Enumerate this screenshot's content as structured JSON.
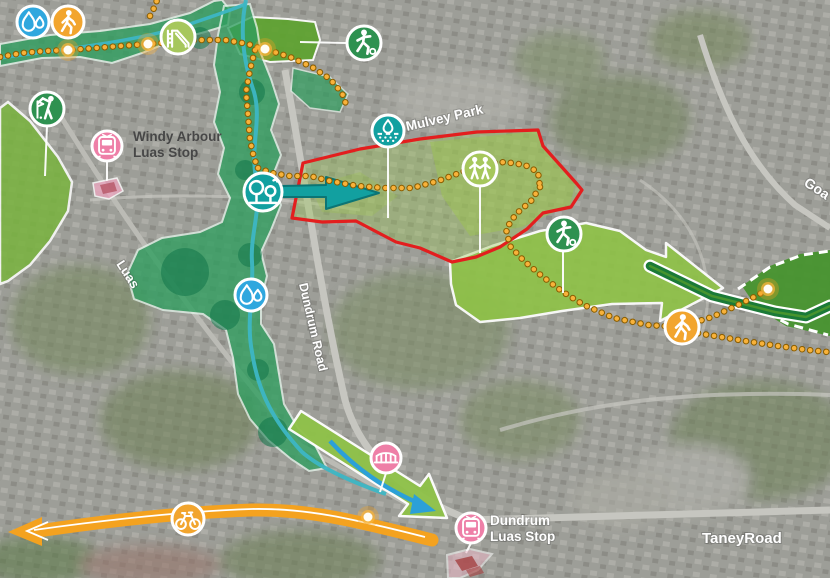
{
  "labels": {
    "mulvey_park": "Mulvey Park",
    "windy_arbour_line1": "Windy Arbour",
    "windy_arbour_line2": "Luas Stop",
    "dundrum_line1": "Dundrum",
    "dundrum_line2": "Luas Stop",
    "luas_line": "Luas",
    "dundrum_road": "Dundrum Road",
    "taney_road": "TaneyRoad",
    "goatstown_road": "Goa"
  },
  "colors": {
    "site_boundary_red": "#e31e1e",
    "route_orange": "#f4a21f",
    "route_orange_core": "#f8b23a",
    "teal": "#12a0a0",
    "green_dark": "#2e9150",
    "green_light": "#a6c75c",
    "blue": "#2fa7de",
    "orange": "#f2a52e",
    "pink": "#ee7fa7",
    "arrow_green": "#8fc248",
    "field_green": "#47942e",
    "chevron_green": "#1b7a38",
    "river_teal": "#3db6c4",
    "river_blue": "#2ba0d8",
    "corridor_green": "#2f9e5f",
    "golf_green": "#79b43e",
    "park_green": "#5ea32f"
  },
  "markers": [
    {
      "name": "water-quality-marker-top",
      "icon": "water-drops-icon"
    },
    {
      "name": "walking-route-marker-top",
      "icon": "walking-person-icon"
    },
    {
      "name": "playground-marker",
      "icon": "playground-slide-icon"
    },
    {
      "name": "sports-pitch-marker-top",
      "icon": "footballer-icon"
    },
    {
      "name": "golf-course-marker",
      "icon": "golfer-icon"
    },
    {
      "name": "windy-arbour-luas-stop-marker",
      "icon": "tram-icon"
    },
    {
      "name": "parkland-trees-marker",
      "icon": "trees-icon"
    },
    {
      "name": "drainage-marker",
      "icon": "rain-drop-icon"
    },
    {
      "name": "community-marker",
      "icon": "people-icon"
    },
    {
      "name": "sports-pitch-marker-mid",
      "icon": "footballer-icon"
    },
    {
      "name": "water-quality-marker-mid",
      "icon": "water-drops-icon"
    },
    {
      "name": "pedestrian-route-marker",
      "icon": "walking-person-icon"
    },
    {
      "name": "cycle-route-marker",
      "icon": "bicycle-icon"
    },
    {
      "name": "bridge-marker",
      "icon": "bridge-icon"
    },
    {
      "name": "dundrum-luas-stop-marker",
      "icon": "tram-icon"
    }
  ]
}
